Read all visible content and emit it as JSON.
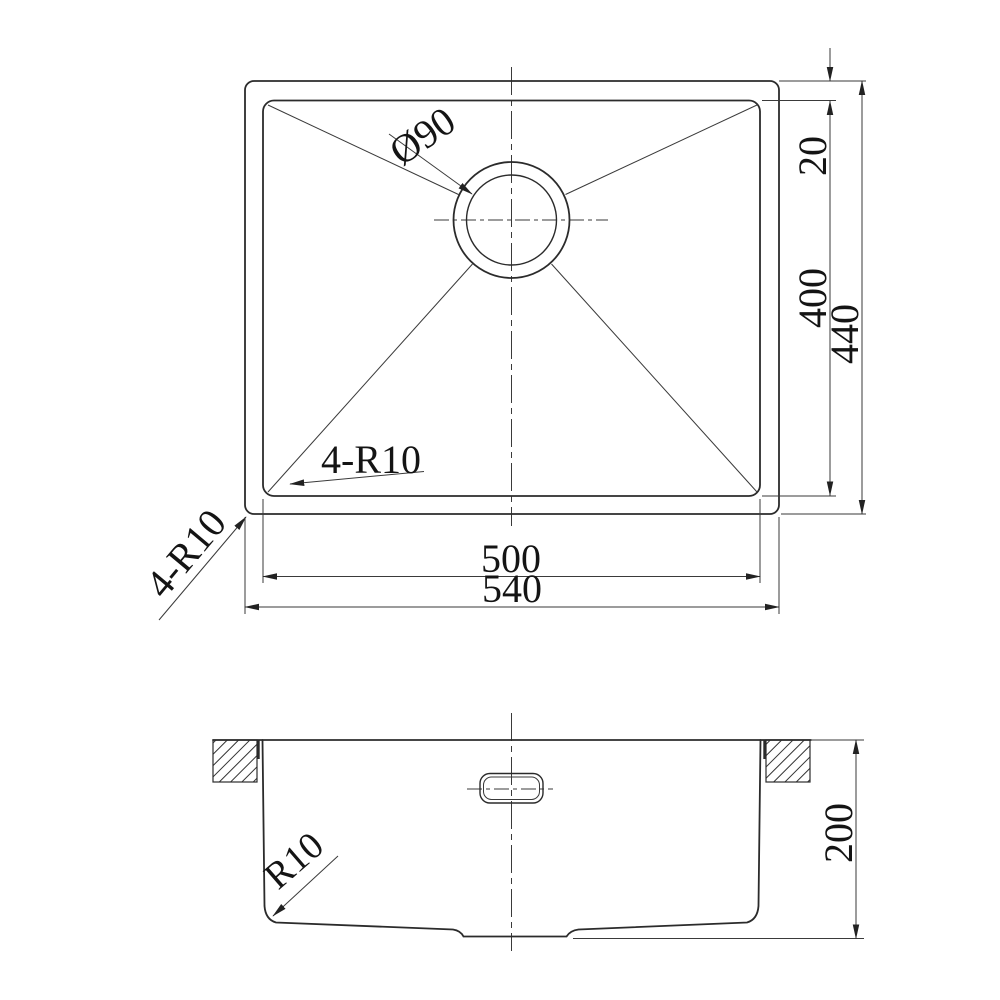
{
  "colors": {
    "line": "#2b2b2b",
    "thin_line": "#3a3a3a",
    "text": "#141414",
    "background": "#ffffff"
  },
  "top_view": {
    "dim_drain_diameter": "Ø90",
    "note_inner_corner_radius": "4-R10",
    "note_outer_corner_radius": "4-R10",
    "dim_rim_offset": "20",
    "dim_bowl_length": "400",
    "dim_overall_length": "440",
    "dim_bowl_width": "500",
    "dim_overall_width": "540"
  },
  "front_view": {
    "note_bottom_corner_radius": "R10",
    "dim_depth": "200"
  }
}
